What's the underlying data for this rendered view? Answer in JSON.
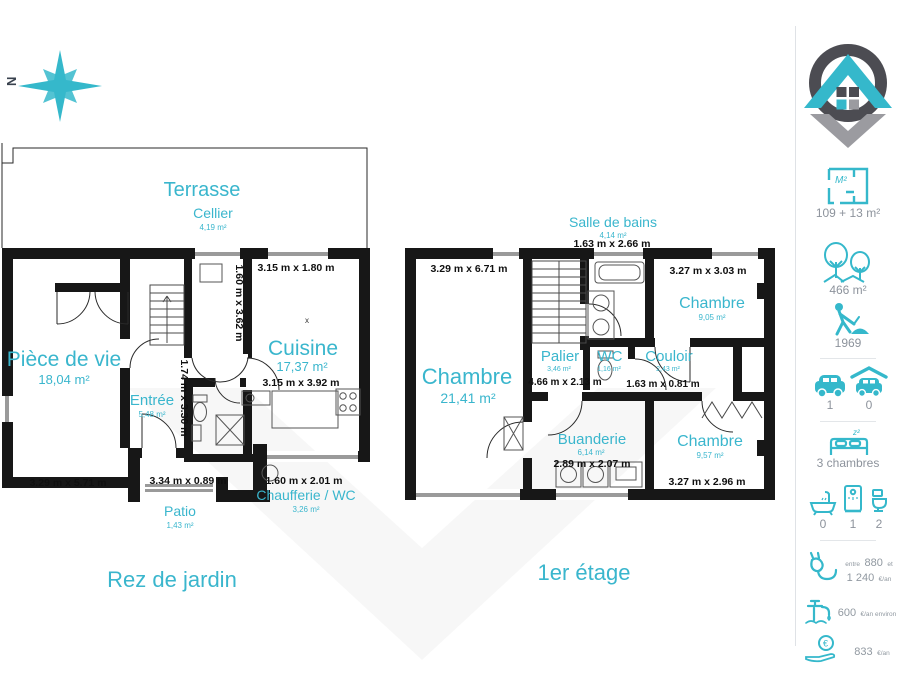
{
  "compass": {
    "label": "N"
  },
  "plans": {
    "ground": {
      "title": "Rez de jardin",
      "terrasse": {
        "label": "Terrasse"
      },
      "cellier": {
        "label": "Cellier",
        "area": "4,19 m²"
      },
      "piece_de_vie": {
        "label": "Pièce de vie",
        "area": "18,04 m²",
        "dim": "3.29 m x 5.71 m"
      },
      "cuisine": {
        "label": "Cuisine",
        "area": "17,37 m²",
        "dim": "3.15 m x 3.92 m"
      },
      "entree": {
        "label": "Entrée",
        "area": "5,48 m²"
      },
      "patio": {
        "label": "Patio",
        "area": "1,43 m²",
        "dim": "3.34 m x 0.89 m"
      },
      "chaufferie": {
        "label": "Chaufferie / WC",
        "area": "3,26 m²",
        "dim": "1.60 m x 2.01 m"
      },
      "dim_top_right": "3.15 m x 1.80 m",
      "dim_cellier_vertical": "1.60 m x 3.62 m",
      "dim_entree_vertical": "1.74 m x 3.30 m",
      "cuisine_mark": "x"
    },
    "first": {
      "title": "1er étage",
      "salle_de_bains": {
        "label": "Salle de bains",
        "area": "4,14 m²",
        "dim": "1.63 m x 2.66 m"
      },
      "chambre_1": {
        "label": "Chambre",
        "area": "21,41 m²",
        "dim": "3.29 m x 6.71 m"
      },
      "chambre_2": {
        "label": "Chambre",
        "area": "9,05 m²",
        "dim": "3.27 m x 3.03 m"
      },
      "chambre_3": {
        "label": "Chambre",
        "area": "9,57 m²",
        "dim": "3.27 m x 2.96 m"
      },
      "palier": {
        "label": "Palier",
        "area": "3,46 m²",
        "dim": "4.66 m x 2.13 m"
      },
      "wc": {
        "label": "WC",
        "area": "1,16 m²"
      },
      "couloir": {
        "label": "Couloir",
        "area": "2,43 m²",
        "dim": "1.63 m x 0.81 m"
      },
      "buanderie": {
        "label": "Buanderie",
        "area": "6,14 m²",
        "dim": "2.89 m x 2.07 m"
      }
    }
  },
  "sidebar": {
    "living_area": "109 + 13 m²",
    "land_area": "466 m²",
    "year_built": "1969",
    "parking_car": "1",
    "parking_garage": "0",
    "bedrooms": "3 chambres",
    "bathtubs": "0",
    "showers": "1",
    "toilets": "2",
    "energy": {
      "prefix": "entre",
      "low": "880",
      "conj": "et",
      "high": "1 240",
      "unit": "€/an"
    },
    "water": {
      "value": "600",
      "unit": "€/an environ"
    },
    "tax": {
      "value": "833",
      "unit": "€/an"
    },
    "icons": [
      "floorplan-icon",
      "trees-icon",
      "construction-worker-icon",
      "car-icon",
      "garage-icon",
      "bed-icon",
      "bathtub-icon",
      "shower-icon",
      "toilet-icon",
      "electric-plug-icon",
      "water-tap-icon",
      "coin-hand-icon"
    ]
  },
  "colors": {
    "accent": "#35b8cb",
    "wall": "#171717",
    "dimension_text": "#101010",
    "sidebar_text": "#8d939c",
    "logo_dark": "#4c4c52",
    "logo_gray": "#9b9ba0"
  }
}
